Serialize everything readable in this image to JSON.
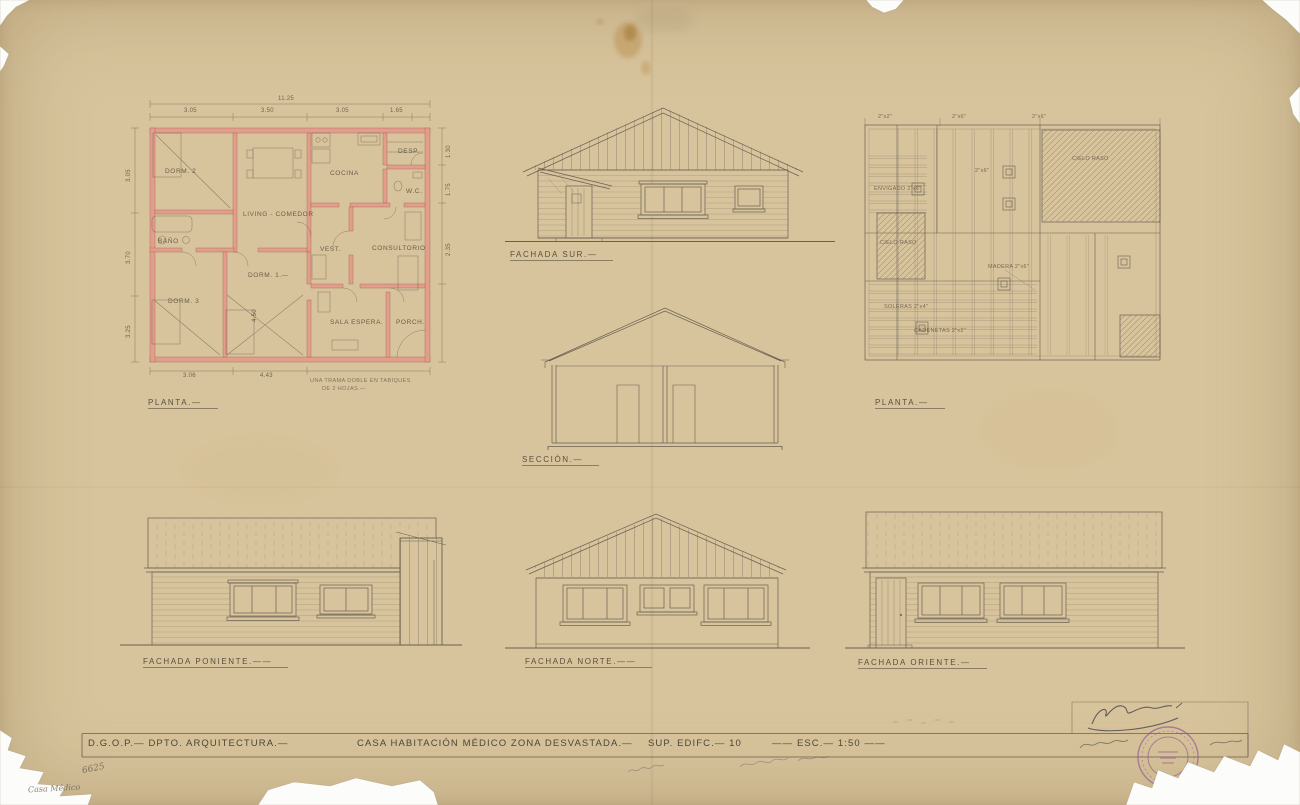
{
  "sheet": {
    "title_block": {
      "seg1": "D.G.O.P.— DPTO. ARQUITECTURA.—",
      "seg2": "CASA HABITACIÓN MÉDICO ZONA DESVASTADA.—",
      "seg3": "SUP. EDIFC.— 10",
      "seg4": "—— ESC.— 1:50 ——"
    },
    "labels": {
      "plan_left": "PLANTA.—",
      "fachada_sur": "FACHADA SUR.—",
      "plan_right": "PLANTA.—",
      "seccion": "SECCIÓN.—",
      "fachada_poniente": "FACHADA PONIENTE.——",
      "fachada_norte": "FACHADA NORTE.——",
      "fachada_oriente": "FACHADA ORIENTE.—"
    },
    "floor_plan": {
      "rooms": {
        "dorm2": "DORM. 2",
        "living": "LIVING - COMEDOR",
        "cocina": "COCINA",
        "desp": "DESP.",
        "wc": "W.C.",
        "bano": "BAÑO",
        "vest": "VEST.",
        "consultorio": "CONSULTORIO",
        "dorm1": "DORM. 1.—",
        "dorm3": "DORM. 3",
        "sala_espera": "SALA ESPERA.",
        "porch": "PORCH."
      },
      "dims": {
        "total": "11.25",
        "t1": "3.05",
        "t2": "3.50",
        "t3": "3.05",
        "t4": "1.65",
        "l1": "3.05",
        "l2": "3.70",
        "l3": "3.25",
        "r1": "1.30",
        "r2": "1.75",
        "r3": "2.35",
        "b1": "3.06",
        "b2": "4.43",
        "inner": "4.50"
      },
      "note1": "UNA TRAMA DOBLE EN TABIQUES",
      "note2": "DE 2 HOJAS.—"
    },
    "framing_plan": {
      "dims": {
        "d1": "2\"x2\"",
        "d2": "2\"x6\"",
        "d3": "2\"x6\"",
        "d4": "2\"x6\""
      },
      "envigado": "ENVIGADO 2\"x6\"",
      "maderas": "MADERA 2\"x6\"",
      "soleras": "SOLERAS 2\"x4\"",
      "cadenetas": "CADENETAS 2\"x2\"",
      "cielo1": "CIELO RASO",
      "cielo2": "CIELO RASO"
    },
    "annotations": {
      "sheet_number": "6625",
      "pencil_note": "Casa Médico"
    },
    "colors": {
      "paper": "#d8c49c",
      "line": "#6a6052",
      "wall_fill": "#e5998a",
      "wall_edge": "#9c5a4c",
      "stamp": "#8d4f93",
      "ink": "#44434b"
    }
  }
}
